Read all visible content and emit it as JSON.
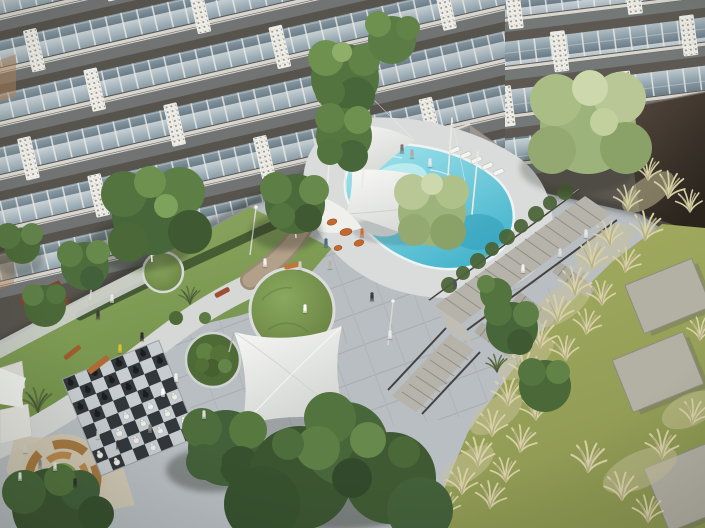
{
  "scene": {
    "type": "architectural-rendering",
    "view": "aerial-courtyard-of-residential-complex",
    "objects": {
      "apartment_building_wings": 2,
      "swimming_pool": 1,
      "shade_sails": 5,
      "sun_loungers": 5,
      "giant_chess_board": 1,
      "chess_pieces_black": 13,
      "chess_pieces_white": 12,
      "grass_mounds": 3,
      "shrub_mound": 1,
      "sunken_lounge_circle": 1,
      "staircase_flights": 4,
      "concrete_lawn_pavers": 3,
      "benches": 4,
      "pergola": 1,
      "play_sculptures": 4,
      "light_poles": 3,
      "people": 30,
      "trees": 16
    }
  },
  "palette": {
    "paving": "#b9bec3",
    "paving_line": "#a6abb0",
    "deck": "#d9dcda",
    "facade_wall": "#57534d",
    "facade_wall_right": "#5d5952",
    "glass_top": "#c6d0d4",
    "glass_mid": "#8fa1ab",
    "glass_bottom": "#697a85",
    "balcony_glass": "#9aabb4",
    "panel_white": "#edece6",
    "slab": "#d7d5d0",
    "end_wall_top": "#55493f",
    "end_wall_bottom": "#2a241d",
    "pool_water": "#45b4cc",
    "pool_water_light": "#a7e6ee",
    "lawn_green": "#6f8f48",
    "lawn_green_light": "#8fa862",
    "lawn_olive": "#8d9852",
    "lawn_olive_light": "#a4ad61",
    "grass_pale": "#d8d1a6",
    "sail_white": "#f8f8f5",
    "sail_shade": "#d2d5d2",
    "path_tan": "#b3a089",
    "wood": "#a6793f",
    "bench_orange": "#b06a35",
    "chess_dark": "#2e3338",
    "chess_light": "#c7cdd1",
    "tree_dark": "#3c5531",
    "tree_mid": "#53743e",
    "tree_light": "#6e9150",
    "tree_pale": "#a9bd85",
    "shadow": "#20281c"
  }
}
